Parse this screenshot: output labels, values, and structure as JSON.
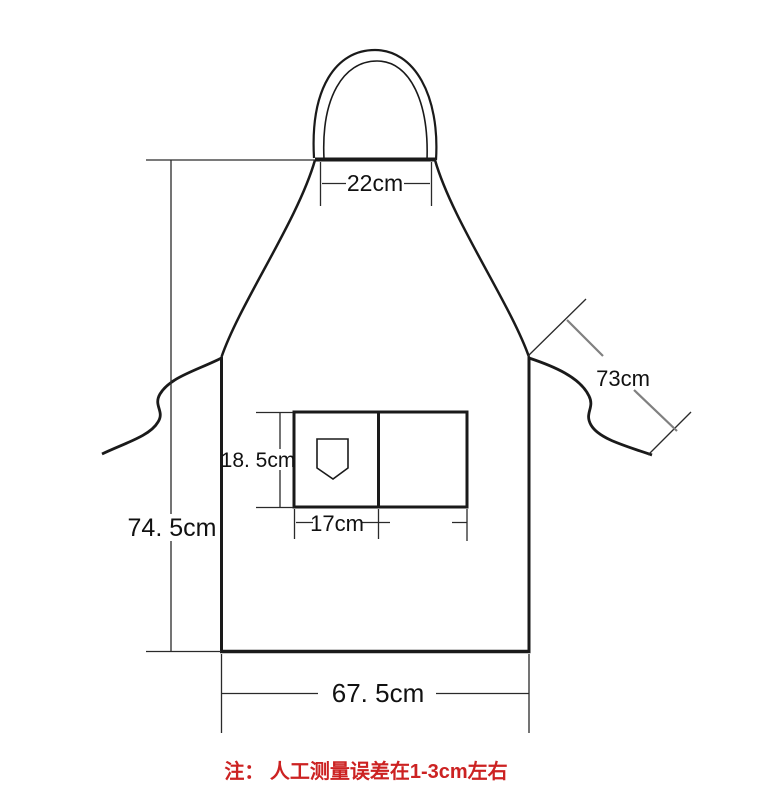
{
  "diagram": {
    "subject": "apron-measurement-diagram",
    "labels": {
      "neck_width": "22cm",
      "strap_length": "73cm",
      "body_height": "74. 5cm",
      "pocket_height": "18. 5cm",
      "pocket_width": "17cm",
      "bottom_width": "67. 5cm"
    },
    "note": "注： 人工测量误差在1-3cm左右",
    "colors": {
      "line": "#1a1a1a",
      "dimension_line": "#2a2a2a",
      "strap_dim_gray": "#808080",
      "note_red": "#cc2222",
      "background": "#ffffff"
    }
  }
}
